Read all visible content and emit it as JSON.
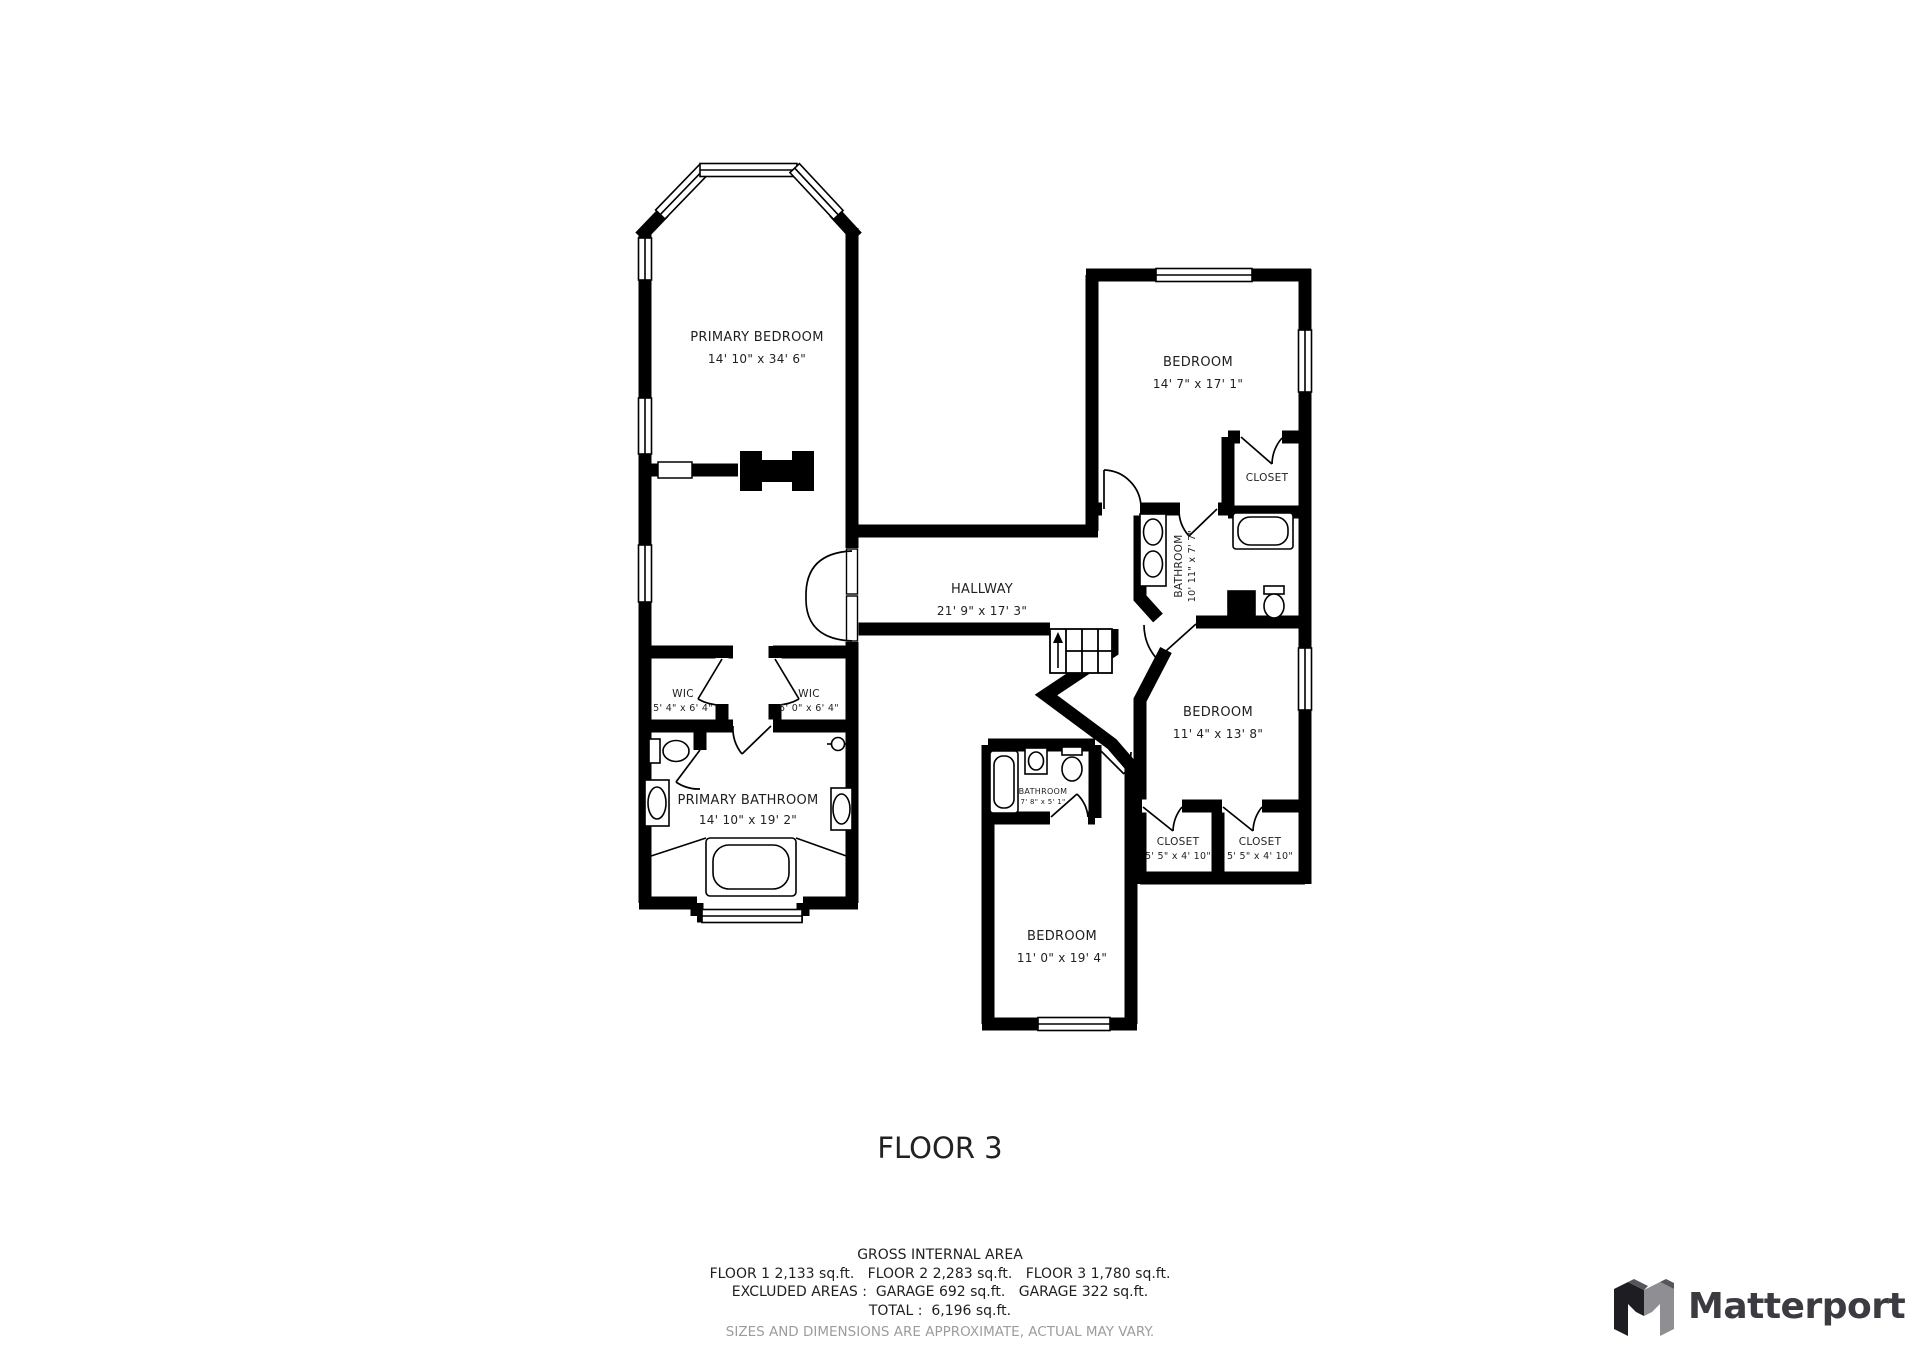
{
  "floor": {
    "title": "FLOOR 3"
  },
  "rooms": {
    "primary_bedroom": {
      "name": "PRIMARY BEDROOM",
      "dims": "14' 10\" x 34' 6\""
    },
    "bedroom_top_right": {
      "name": "BEDROOM",
      "dims": "14' 7\" x 17' 1\""
    },
    "hallway": {
      "name": "HALLWAY",
      "dims": "21' 9\" x 17' 3\""
    },
    "wic_left": {
      "name": "WIC",
      "dims": "5' 4\" x 6' 4\""
    },
    "wic_right": {
      "name": "WIC",
      "dims": "5' 0\" x 6' 4\""
    },
    "primary_bathroom": {
      "name": "PRIMARY BATHROOM",
      "dims": "14' 10\" x 19' 2\""
    },
    "bathroom_right": {
      "name": "BATHROOM",
      "dims": "10' 11\" x 7' 7\""
    },
    "closet_top_right": {
      "name": "CLOSET"
    },
    "bedroom_mid_right": {
      "name": "BEDROOM",
      "dims": "11' 4\" x 13' 8\""
    },
    "closet_left": {
      "name": "CLOSET",
      "dims": "5' 5\" x 4' 10\""
    },
    "closet_right": {
      "name": "CLOSET",
      "dims": "5' 5\" x 4' 10\""
    },
    "bathroom_small": {
      "name": "BATHROOM",
      "dims": "7' 8\" x 5' 1\""
    },
    "bedroom_bottom": {
      "name": "BEDROOM",
      "dims": "11' 0\" x 19' 4\""
    }
  },
  "footer": {
    "gross_heading": "GROSS INTERNAL AREA",
    "floors_line": "FLOOR 1 2,133 sq.ft.   FLOOR 2 2,283 sq.ft.   FLOOR 3 1,780 sq.ft.",
    "excluded_line": "EXCLUDED AREAS :  GARAGE 692 sq.ft.   GARAGE 322 sq.ft.",
    "total_line": "TOTAL :  6,196 sq.ft.",
    "disclaimer": "SIZES AND DIMENSIONS ARE APPROXIMATE, ACTUAL MAY VARY."
  },
  "brand": {
    "name": "Matterport"
  },
  "colors": {
    "wall": "#000000",
    "label": "#1f1f1f",
    "disclaimer": "#9d9d9d",
    "brand_dark": "#3b3b41",
    "brand_gray": "#8e8e93"
  }
}
